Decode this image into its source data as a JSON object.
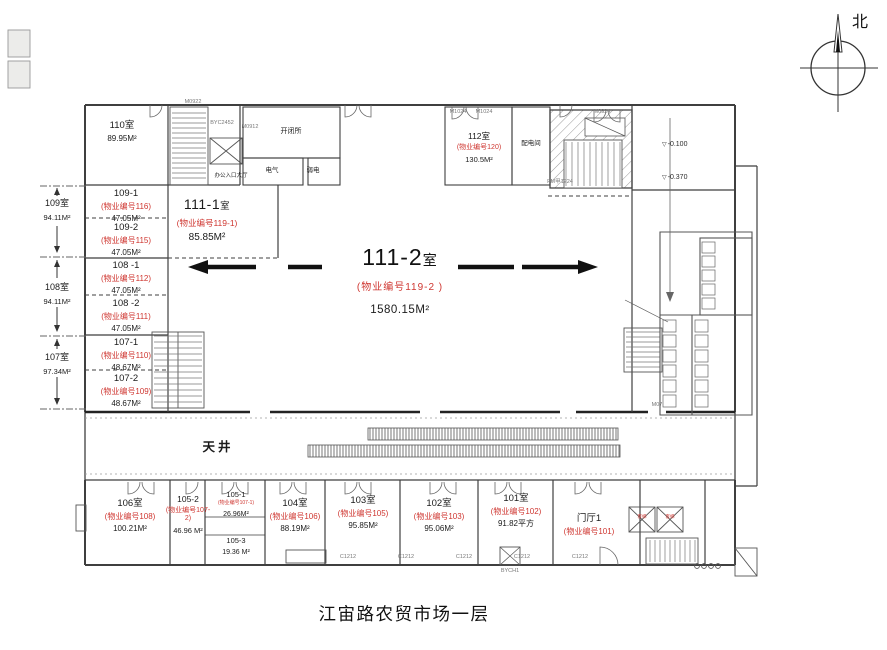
{
  "colors": {
    "red": "#cf3630",
    "line": "#3f3f3f",
    "dark": "#111111"
  },
  "title": "江宙路农贸市场一层",
  "compass": {
    "label": "北"
  },
  "rooms": [
    {
      "id": "r110",
      "name": "110室",
      "prop": "",
      "area": "89.95M²"
    },
    {
      "id": "r109_1",
      "name": "109-1",
      "prop": "(物业编号116)",
      "area": "47.05M²"
    },
    {
      "id": "r109_2",
      "name": "109-2",
      "prop": "(物业编号115)",
      "area": "47.05M²"
    },
    {
      "id": "r108_1",
      "name": "108 -1",
      "prop": "(物业编号112)",
      "area": "47.05M²"
    },
    {
      "id": "r108_2",
      "name": "108 -2",
      "prop": "(物业编号111)",
      "area": "47.05M²"
    },
    {
      "id": "r107_1",
      "name": "107-1",
      "prop": "(物业编号110)",
      "area": "48.67M²"
    },
    {
      "id": "r107_2",
      "name": "107-2",
      "prop": "(物业编号109)",
      "area": "48.67M²"
    },
    {
      "id": "r111_1",
      "name": "111-1",
      "suffix": "室",
      "prop": "(物业编号119-1)",
      "area": "85.85M²"
    },
    {
      "id": "r111_2",
      "name": "111-2",
      "suffix": "室",
      "prop": "(物业编号119-2 )",
      "area": "1580.15M²"
    },
    {
      "id": "r112",
      "name": "112室",
      "prop": "(物业编号120)",
      "area": "130.5M²"
    },
    {
      "id": "r106",
      "name": "106室",
      "prop": "(物业编号108)",
      "area": "100.21M²"
    },
    {
      "id": "r105_2",
      "name": "105-2",
      "prop": "(物业编号107-2)",
      "area": "46.96 M²"
    },
    {
      "id": "r105_1",
      "name": "105-1",
      "prop": "(物业编号107-1)",
      "area": "26.96M²"
    },
    {
      "id": "r105_3",
      "name": "105-3",
      "prop": "",
      "area": "19.36 M²"
    },
    {
      "id": "r104",
      "name": "104室",
      "prop": "(物业编号106)",
      "area": "88.19M²"
    },
    {
      "id": "r103",
      "name": "103室",
      "prop": "(物业编号105)",
      "area": "95.85M²"
    },
    {
      "id": "r102",
      "name": "102室",
      "prop": "(物业编号103)",
      "area": "95.06M²"
    },
    {
      "id": "r101",
      "name": "101室",
      "prop": "(物业编号102)",
      "area": "91.82平方"
    },
    {
      "id": "rmt",
      "name": "门厅1",
      "prop": "(物业编号101)",
      "area": ""
    }
  ],
  "side_rooms": [
    {
      "id": "s109",
      "name": "109室",
      "area": "94.11M²"
    },
    {
      "id": "s108",
      "name": "108室",
      "area": "94.11M²"
    },
    {
      "id": "s107",
      "name": "107室",
      "area": "97.34M²"
    }
  ],
  "annotations": [
    {
      "id": "tianjing",
      "text": "天井"
    },
    {
      "id": "kaibisuo",
      "text": "开闭所"
    },
    {
      "id": "dianqi",
      "text": "电气"
    },
    {
      "id": "ruodian",
      "text": "弱电"
    },
    {
      "id": "peidian",
      "text": "配电间"
    },
    {
      "id": "lobby",
      "text": "办公入口大厅"
    },
    {
      "id": "ele1",
      "text": "客梯"
    },
    {
      "id": "ele2",
      "text": "客梯"
    }
  ],
  "elevations": [
    {
      "id": "lv1",
      "text": "-0.100"
    },
    {
      "id": "lv2",
      "text": "-0.370"
    }
  ],
  "codes": [
    "M0922",
    "BYC2452",
    "M0912",
    "M1024",
    "M1024",
    "M0924",
    "FM甲1224",
    "M07",
    "C1212",
    "C1212",
    "C1212",
    "C1212",
    "C1212",
    "BYCH1"
  ]
}
